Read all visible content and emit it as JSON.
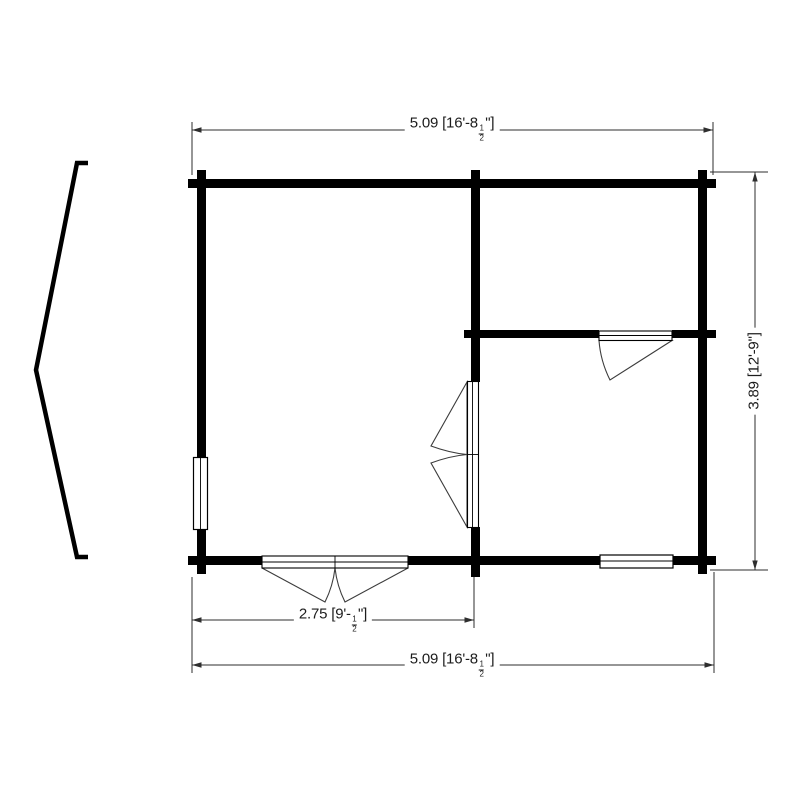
{
  "plan": {
    "type": "floor-plan",
    "description": "Two-room cabin floor plan with roof gable profile at left",
    "colors": {
      "wall": "#000000",
      "dim_line": "#2e2e2e",
      "swing_line": "#3c3c3c",
      "background": "#ffffff",
      "text": "#1c1c1c"
    },
    "dimensions": {
      "top_width": {
        "metric": "5.09",
        "imperial_open": " [16'-8",
        "frac_num": "1",
        "frac_den": "2",
        "imperial_close": "\"]"
      },
      "right_height": {
        "metric": "3.89",
        "imperial": " [12'-9\"]"
      },
      "bottom_left_width": {
        "metric": "2.75",
        "imperial_open": " [9'-",
        "frac_num": "1",
        "frac_den": "2",
        "imperial_close": "\"]"
      },
      "bottom_total_width": {
        "metric": "5.09",
        "imperial_open": " [16'-8",
        "frac_num": "1",
        "frac_den": "2",
        "imperial_close": "\"]"
      }
    }
  }
}
